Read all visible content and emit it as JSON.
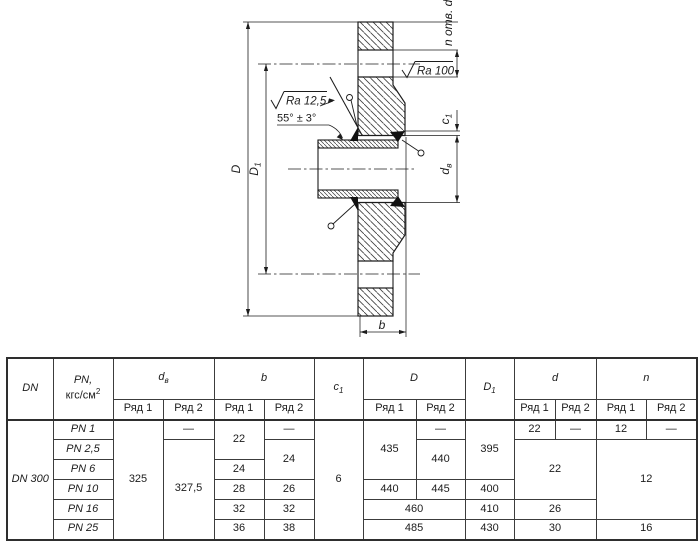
{
  "drawing": {
    "labels": {
      "n_holes": "n отв. d",
      "ra_face": "Ra 100",
      "ra_bevel": "Ra 12,5",
      "angle": "55° ± 3°",
      "dim_outer": "D",
      "dim_bolt_base": "D",
      "dim_bolt_sub": "1",
      "dim_collar_base": "c",
      "dim_collar_sub": "1",
      "dim_bore_base": "d",
      "dim_bore_sub": "в",
      "dim_thickness": "b"
    }
  },
  "table": {
    "header": {
      "dn": "DN",
      "pn_line1": "PN,",
      "pn_unit_base": "кгс/см",
      "pn_unit_sup": "2",
      "db_base": "d",
      "db_sub": "в",
      "b": "b",
      "c1_base": "c",
      "c1_sub": "1",
      "D": "D",
      "D1_base": "D",
      "D1_sub": "1",
      "d": "d",
      "n": "n",
      "row1": "Ряд 1",
      "row2": "Ряд 2"
    },
    "cells": {
      "dn": "DN 300",
      "pn_1": "PN 1",
      "pn_2": "PN 2,5",
      "pn_3": "PN 6",
      "pn_4": "PN 10",
      "pn_5": "PN 16",
      "pn_6": "PN 25",
      "db_r1": "325",
      "db_r2_row1": "—",
      "db_r2_rows2to6": "327,5",
      "b_r1_rows12": "22",
      "b_r1_row3": "24",
      "b_r1_row4": "28",
      "b_r1_row5": "32",
      "b_r1_row6": "36",
      "b_r2_row1": "—",
      "b_r2_rows23": "24",
      "b_r2_row4": "26",
      "b_r2_row5": "32",
      "b_r2_row6": "38",
      "c1": "6",
      "D_r1_rows123": "435",
      "D_r1_row4": "440",
      "D_r2_row1": "—",
      "D_r2_rows23": "440",
      "D_r2_row4": "445",
      "D_row5": "460",
      "D_row6": "485",
      "D1_rows123": "395",
      "D1_row4": "400",
      "D1_row5": "410",
      "D1_row6": "430",
      "d_r1_row1": "22",
      "d_r2_row1": "—",
      "d_rows234": "22",
      "d_row5": "26",
      "d_row6": "30",
      "n_r1_row1": "12",
      "n_r2_row1": "—",
      "n_rows2345": "12",
      "n_row6": "16"
    }
  }
}
